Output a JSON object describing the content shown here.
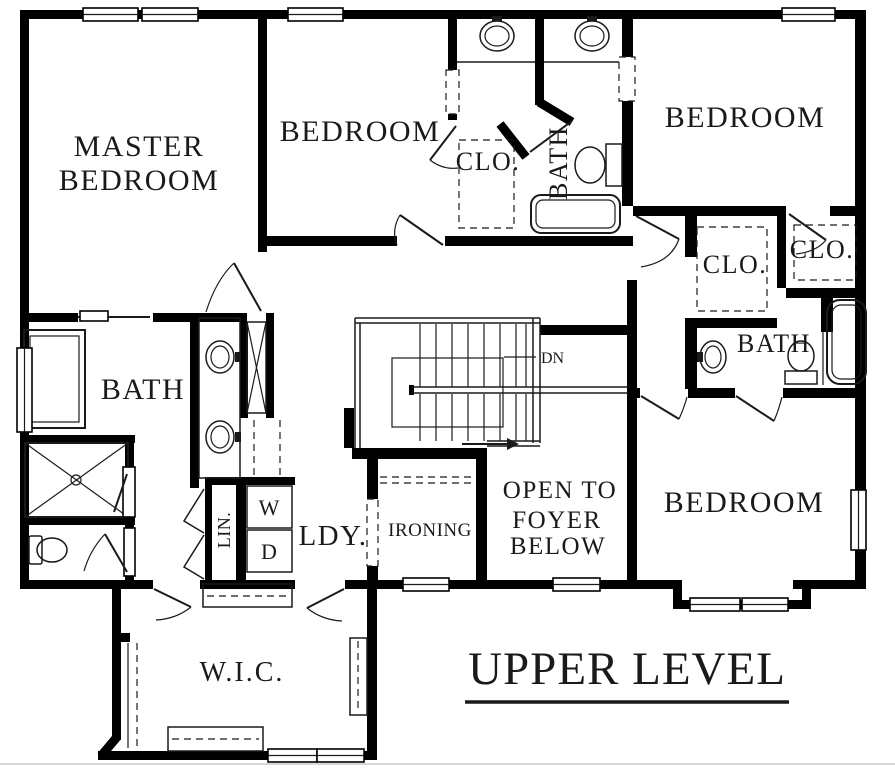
{
  "plan": {
    "title": "UPPER LEVEL",
    "labels": {
      "master_line1": "MASTER",
      "master_line2": "BEDROOM",
      "bedroom_top": "BEDROOM",
      "bedroom_right": "BEDROOM",
      "bedroom_bottom": "BEDROOM",
      "clo_top": "CLO.",
      "clo_inner": "CLO.",
      "clo_outer": "CLO.",
      "bath_top": "BATH",
      "bath_master": "BATH",
      "bath_right": "BATH",
      "stairs_down": "DN",
      "foyer_line1": "OPEN TO",
      "foyer_line2": "FOYER",
      "foyer_line3": "BELOW",
      "ironing": "IRONING",
      "laundry": "LDY.",
      "washer": "W",
      "dryer": "D",
      "linen": "LIN.",
      "walk_in_closet": "W.I.C."
    },
    "colors": {
      "wall": "#000000",
      "background": "#ffffff",
      "line": "#1a1a1a"
    }
  }
}
